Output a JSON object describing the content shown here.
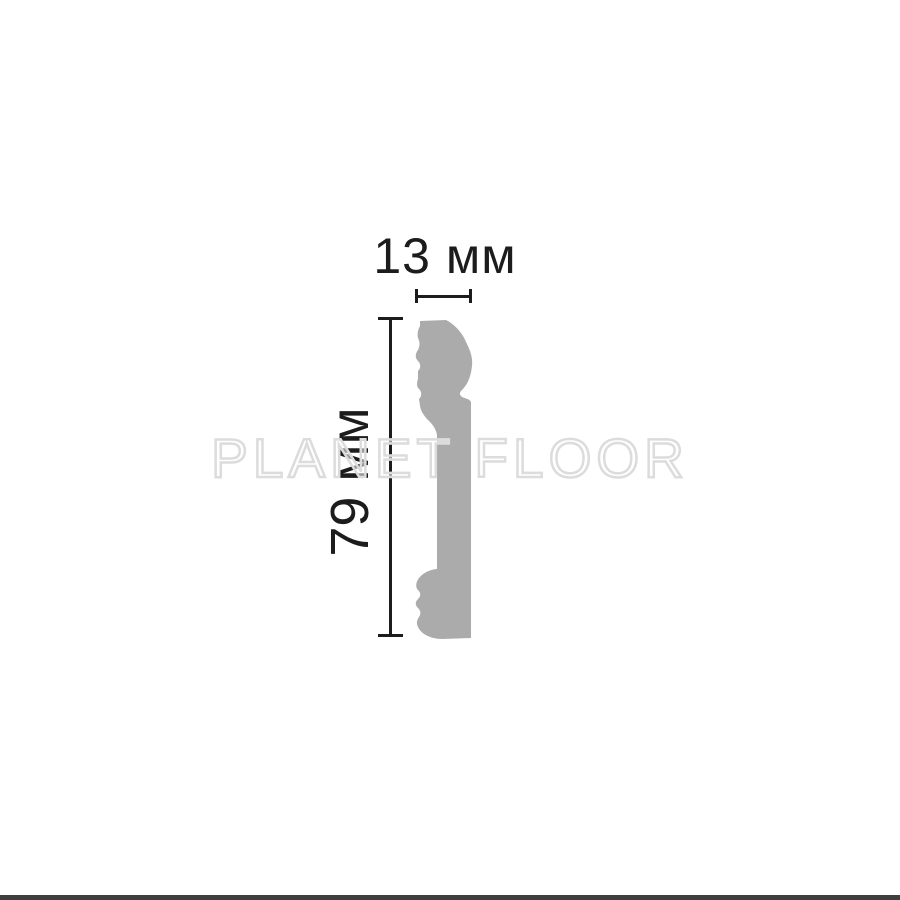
{
  "diagram": {
    "title": "skirting-board profile cross-section with dimensions",
    "watermark": "PLANET FLOOR",
    "dimensions": {
      "width": {
        "label": "13 мм",
        "value_mm": 13
      },
      "height": {
        "label": "79 мм",
        "value_mm": 79
      }
    }
  },
  "colors": {
    "background": "#ffffff",
    "profile_fill": "#ababab",
    "dimension": "#1c1c1c",
    "watermark_outline": "#dcdcdc",
    "bottom_bar": "#3e3e3e"
  }
}
